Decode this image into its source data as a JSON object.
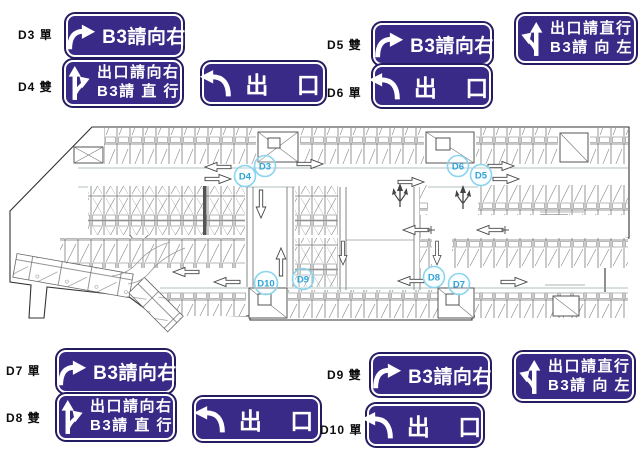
{
  "title": "B3 parking level guidance sign plan",
  "signs": {
    "b3_right": {
      "text": "B3請向右"
    },
    "exit": {
      "text": "出 口"
    },
    "exit_right": {
      "line1": "出口請向右",
      "line2": "B3請 直 行"
    },
    "exit_straight": {
      "line1": "出口請直行",
      "line2": "B3請 向 左"
    }
  },
  "labels": {
    "d3": "D3 單",
    "d4": "D4 雙",
    "d5": "D5 雙",
    "d6": "D6 單",
    "d7": "D7 單",
    "d8": "D8 雙",
    "d9": "D9 雙",
    "d10": "D10 單"
  },
  "plan": {
    "markers": [
      {
        "t": "D3"
      },
      {
        "t": "D4"
      },
      {
        "t": "D5"
      },
      {
        "t": "D6"
      },
      {
        "t": "D7"
      },
      {
        "t": "D8"
      },
      {
        "t": "D9"
      },
      {
        "t": "D10"
      }
    ]
  },
  "icons": {
    "curve_right_arrow": "arrow curving up then right",
    "hook_left_arrow": "arrow curving up then hooking left",
    "fork_right_arrow": "straight-up arrow with right branch",
    "fork_left_arrow": "straight-up arrow with left branch",
    "lane_arrow": "hollow outline lane direction arrow"
  },
  "colors": {
    "sign_bg": "#3a2a87",
    "sign_border": "#ffffff",
    "sign_outline": "#241c60",
    "marker_ring": "#8ad4ee",
    "marker_text": "#2fa3d8",
    "plan_line": "#555555"
  }
}
